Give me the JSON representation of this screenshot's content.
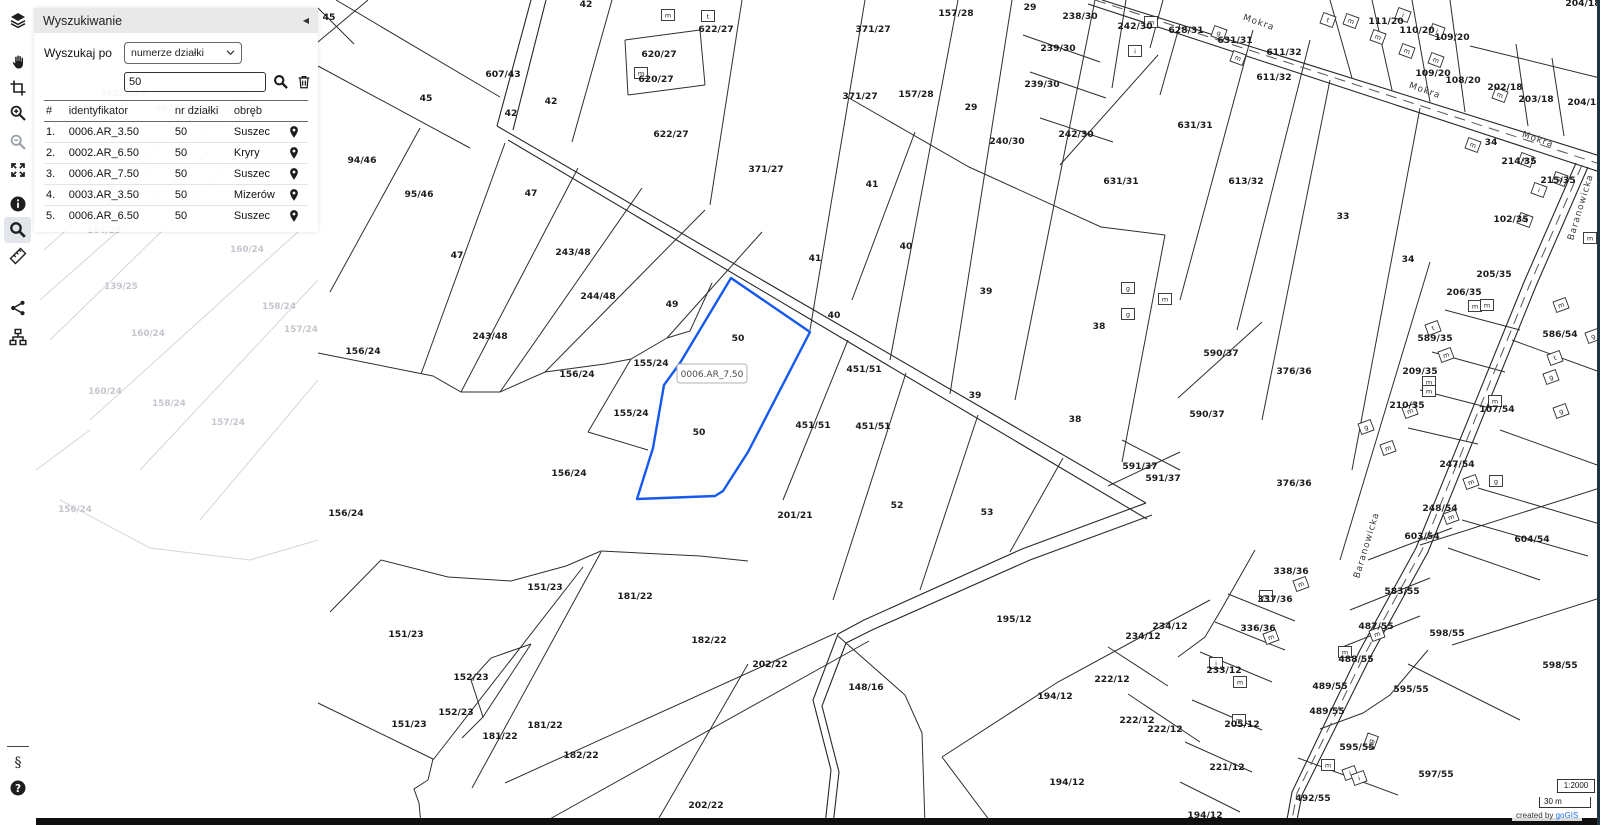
{
  "toolbar": {
    "items": [
      {
        "name": "layers"
      },
      {
        "name": "pan"
      },
      {
        "name": "select-area"
      },
      {
        "name": "zoom-in"
      },
      {
        "name": "zoom-out",
        "disabled": true
      },
      {
        "name": "full-extent"
      },
      {
        "name": "info"
      },
      {
        "name": "search",
        "active": true
      },
      {
        "name": "measure"
      },
      {
        "name": "share"
      },
      {
        "name": "layer-tree"
      }
    ],
    "bottom_items": [
      {
        "name": "legal"
      },
      {
        "name": "help"
      }
    ]
  },
  "search_panel": {
    "title": "Wyszukiwanie",
    "collapse_glyph": "◀",
    "search_by_label": "Wyszukaj po",
    "search_by_value": "numerze działki",
    "query_value": "50",
    "table": {
      "columns": [
        "#",
        "identyfikator",
        "nr działki",
        "obręb",
        ""
      ],
      "rows": [
        {
          "index": "1.",
          "id": "0006.AR_3.50",
          "plot": "50",
          "district": "Suszec"
        },
        {
          "index": "2.",
          "id": "0002.AR_6.50",
          "plot": "50",
          "district": "Kryry"
        },
        {
          "index": "3.",
          "id": "0006.AR_7.50",
          "plot": "50",
          "district": "Suszec"
        },
        {
          "index": "4.",
          "id": "0003.AR_3.50",
          "plot": "50",
          "district": "Mizerów"
        },
        {
          "index": "5.",
          "id": "0006.AR_6.50",
          "plot": "50",
          "district": "Suszec"
        }
      ]
    }
  },
  "map": {
    "highlight": {
      "label": "0006.AR_7.50",
      "color": "#1659ef"
    },
    "street_labels": [
      {
        "text": "Mokra",
        "x": 1258,
        "y": 25,
        "rot": 19
      },
      {
        "text": "Mokra",
        "x": 1424,
        "y": 93,
        "rot": 19
      },
      {
        "text": "Mokra",
        "x": 1537,
        "y": 142,
        "rot": 19
      },
      {
        "text": "Baranowicka",
        "x": 1583,
        "y": 208,
        "rot": -73
      },
      {
        "text": "Baranowicka",
        "x": 1369,
        "y": 546,
        "rot": -73
      }
    ],
    "parcel_labels": [
      [
        "45",
        329,
        20
      ],
      [
        "42",
        586,
        7
      ],
      [
        "607/43",
        503,
        77
      ],
      [
        "45",
        426,
        101
      ],
      [
        "42",
        511,
        116
      ],
      [
        "42",
        551,
        104
      ],
      [
        "622/27",
        716,
        32
      ],
      [
        "620/27",
        659,
        57
      ],
      [
        "620/27",
        656,
        82
      ],
      [
        "622/27",
        671,
        137
      ],
      [
        "94/46",
        362,
        163
      ],
      [
        "95/46",
        419,
        197
      ],
      [
        "47",
        531,
        196
      ],
      [
        "47",
        457,
        258
      ],
      [
        "243/48",
        573,
        255
      ],
      [
        "243/48",
        490,
        339
      ],
      [
        "244/48",
        598,
        299
      ],
      [
        "49",
        672,
        307
      ],
      [
        "155/24",
        651,
        366
      ],
      [
        "155/24",
        631,
        416
      ],
      [
        "156/24",
        363,
        354
      ],
      [
        "156/24",
        577,
        377
      ],
      [
        "156/24",
        569,
        476
      ],
      [
        "156/24",
        346,
        516
      ],
      [
        "50",
        738,
        341
      ],
      [
        "50",
        699,
        435
      ],
      [
        "371/27",
        873,
        32
      ],
      [
        "157/28",
        956,
        16
      ],
      [
        "29",
        1030,
        10
      ],
      [
        "238/30",
        1080,
        19
      ],
      [
        "242/30",
        1135,
        29
      ],
      [
        "239/30",
        1058,
        51
      ],
      [
        "239/30",
        1042,
        87
      ],
      [
        "371/27",
        860,
        99
      ],
      [
        "157/28",
        916,
        97
      ],
      [
        "29",
        971,
        110
      ],
      [
        "240/30",
        1007,
        144
      ],
      [
        "242/30",
        1076,
        137
      ],
      [
        "631/31",
        1121,
        184
      ],
      [
        "371/27",
        766,
        172
      ],
      [
        "41",
        872,
        187
      ],
      [
        "41",
        815,
        261
      ],
      [
        "40",
        906,
        249
      ],
      [
        "40",
        834,
        318
      ],
      [
        "628/31",
        1186,
        33
      ],
      [
        "631/31",
        1235,
        43
      ],
      [
        "611/32",
        1284,
        55
      ],
      [
        "611/32",
        1274,
        80
      ],
      [
        "111/20",
        1386,
        24
      ],
      [
        "110/20",
        1417,
        33
      ],
      [
        "109/20",
        1452,
        40
      ],
      [
        "109/20",
        1433,
        76
      ],
      [
        "108/20",
        1463,
        83
      ],
      [
        "202/18",
        1505,
        90
      ],
      [
        "203/18",
        1536,
        102
      ],
      [
        "204/18",
        1585,
        105
      ],
      [
        "204/18",
        1583,
        6
      ],
      [
        "631/31",
        1195,
        128
      ],
      [
        "613/32",
        1246,
        184
      ],
      [
        "33",
        1343,
        219
      ],
      [
        "34",
        1491,
        145
      ],
      [
        "34",
        1408,
        262
      ],
      [
        "214/35",
        1519,
        164
      ],
      [
        "215/35",
        1558,
        183
      ],
      [
        "102/35",
        1511,
        222
      ],
      [
        "205/35",
        1494,
        277
      ],
      [
        "206/35",
        1464,
        295
      ],
      [
        "586/54",
        1560,
        337
      ],
      [
        "589/35",
        1435,
        341
      ],
      [
        "209/35",
        1420,
        374
      ],
      [
        "210/35",
        1407,
        408
      ],
      [
        "107/54",
        1497,
        412
      ],
      [
        "590/37",
        1221,
        356
      ],
      [
        "376/36",
        1294,
        374
      ],
      [
        "590/37",
        1207,
        417
      ],
      [
        "376/36",
        1294,
        486
      ],
      [
        "591/37",
        1140,
        469
      ],
      [
        "591/37",
        1163,
        481
      ],
      [
        "451/51",
        864,
        372
      ],
      [
        "451/51",
        813,
        428
      ],
      [
        "451/51",
        873,
        429
      ],
      [
        "39",
        986,
        294
      ],
      [
        "39",
        975,
        398
      ],
      [
        "38",
        1099,
        329
      ],
      [
        "38",
        1075,
        422
      ],
      [
        "52",
        897,
        508
      ],
      [
        "53",
        987,
        515
      ],
      [
        "201/21",
        795,
        518
      ],
      [
        "247/54",
        1457,
        467
      ],
      [
        "248/54",
        1440,
        511
      ],
      [
        "603/54",
        1422,
        539
      ],
      [
        "604/54",
        1532,
        542
      ],
      [
        "151/23",
        545,
        590
      ],
      [
        "181/22",
        635,
        599
      ],
      [
        "151/23",
        406,
        637
      ],
      [
        "182/22",
        709,
        643
      ],
      [
        "152/23",
        471,
        680
      ],
      [
        "152/23",
        456,
        715
      ],
      [
        "151/23",
        409,
        727
      ],
      [
        "181/22",
        500,
        739
      ],
      [
        "181/22",
        545,
        728
      ],
      [
        "182/22",
        581,
        758
      ],
      [
        "202/22",
        706,
        808
      ],
      [
        "202/22",
        770,
        667
      ],
      [
        "148/16",
        866,
        690
      ],
      [
        "195/12",
        1014,
        622
      ],
      [
        "234/12",
        1143,
        639
      ],
      [
        "234/12",
        1170,
        629
      ],
      [
        "222/12",
        1112,
        682
      ],
      [
        "194/12",
        1055,
        699
      ],
      [
        "222/12",
        1137,
        723
      ],
      [
        "222/12",
        1165,
        732
      ],
      [
        "194/12",
        1067,
        785
      ],
      [
        "194/12",
        1205,
        818
      ],
      [
        "338/36",
        1291,
        574
      ],
      [
        "337/36",
        1275,
        602
      ],
      [
        "336/36",
        1258,
        631
      ],
      [
        "233/12",
        1224,
        673
      ],
      [
        "205/12",
        1242,
        727
      ],
      [
        "221/12",
        1227,
        770
      ],
      [
        "583/55",
        1402,
        594
      ],
      [
        "487/55",
        1376,
        629
      ],
      [
        "598/55",
        1447,
        636
      ],
      [
        "488/55",
        1356,
        662
      ],
      [
        "598/55",
        1560,
        668
      ],
      [
        "489/55",
        1330,
        689
      ],
      [
        "595/55",
        1411,
        692
      ],
      [
        "489/55",
        1327,
        714
      ],
      [
        "595/55",
        1357,
        750
      ],
      [
        "597/55",
        1436,
        777
      ],
      [
        "492/55",
        1313,
        801
      ]
    ],
    "faint_labels": [
      [
        "4427/399",
        123,
        96
      ],
      [
        "4427/399",
        178,
        111
      ],
      [
        "164/25",
        104,
        233
      ],
      [
        "160/24",
        247,
        252
      ],
      [
        "139/25",
        121,
        289
      ],
      [
        "158/24",
        279,
        309
      ],
      [
        "157/24",
        301,
        332
      ],
      [
        "160/24",
        148,
        336
      ],
      [
        "160/24",
        105,
        394
      ],
      [
        "158/24",
        169,
        406
      ],
      [
        "157/24",
        228,
        425
      ],
      [
        "156/24",
        75,
        512
      ]
    ],
    "buildings": [
      [
        668,
        15,
        "m",
        0
      ],
      [
        708,
        16,
        "t",
        0
      ],
      [
        641,
        73,
        "m",
        0
      ],
      [
        1151,
        22,
        "m",
        0
      ],
      [
        1135,
        51,
        "i",
        0
      ],
      [
        1219,
        33,
        "g",
        20
      ],
      [
        1238,
        58,
        "m",
        20
      ],
      [
        1328,
        20,
        "t",
        20
      ],
      [
        1351,
        21,
        "m",
        20
      ],
      [
        1378,
        37,
        "m",
        20
      ],
      [
        1403,
        15,
        "i",
        20
      ],
      [
        1437,
        31,
        "i",
        20
      ],
      [
        1407,
        51,
        "m",
        20
      ],
      [
        1436,
        60,
        "m",
        20
      ],
      [
        1500,
        95,
        "m",
        20
      ],
      [
        1473,
        145,
        "m",
        20
      ],
      [
        1526,
        160,
        "m",
        20
      ],
      [
        1560,
        179,
        "m",
        20
      ],
      [
        1539,
        190,
        "i",
        20
      ],
      [
        1525,
        220,
        "m",
        20
      ],
      [
        1590,
        238,
        "m",
        0
      ],
      [
        1128,
        288,
        "g",
        0
      ],
      [
        1165,
        299,
        "m",
        0
      ],
      [
        1128,
        314,
        "g",
        0
      ],
      [
        1475,
        306,
        "m",
        0
      ],
      [
        1487,
        305,
        "m",
        0
      ],
      [
        1433,
        328,
        "t",
        -20
      ],
      [
        1446,
        355,
        "m",
        -20
      ],
      [
        1429,
        382,
        "m",
        0
      ],
      [
        1429,
        391,
        "m",
        0
      ],
      [
        1410,
        411,
        "m",
        -20
      ],
      [
        1366,
        427,
        "g",
        -20
      ],
      [
        1388,
        448,
        "m",
        -20
      ],
      [
        1561,
        305,
        "m",
        -20
      ],
      [
        1593,
        336,
        "g",
        -20
      ],
      [
        1555,
        358,
        "t",
        -20
      ],
      [
        1551,
        377,
        "g",
        -20
      ],
      [
        1561,
        411,
        "g",
        -20
      ],
      [
        1495,
        401,
        "m",
        0
      ],
      [
        1471,
        482,
        "m",
        -20
      ],
      [
        1496,
        481,
        "g",
        0
      ],
      [
        1451,
        517,
        "m",
        -20
      ],
      [
        1301,
        584,
        "m",
        -20
      ],
      [
        1266,
        596,
        "m",
        0
      ],
      [
        1271,
        637,
        "m",
        -20
      ],
      [
        1216,
        663,
        "i",
        0
      ],
      [
        1240,
        682,
        "m",
        0
      ],
      [
        1239,
        720,
        "m",
        0
      ],
      [
        1377,
        634,
        "m",
        -20
      ],
      [
        1345,
        652,
        "m",
        0
      ],
      [
        1371,
        741,
        "g",
        -70
      ],
      [
        1328,
        765,
        "m",
        0
      ],
      [
        1350,
        773,
        "i",
        -20
      ],
      [
        1359,
        778,
        "i",
        -20
      ]
    ]
  },
  "scale": {
    "ratio": "1:2000",
    "bar_label": "30 m"
  },
  "attribution": {
    "prefix": "created by",
    "link": "goGIS"
  }
}
